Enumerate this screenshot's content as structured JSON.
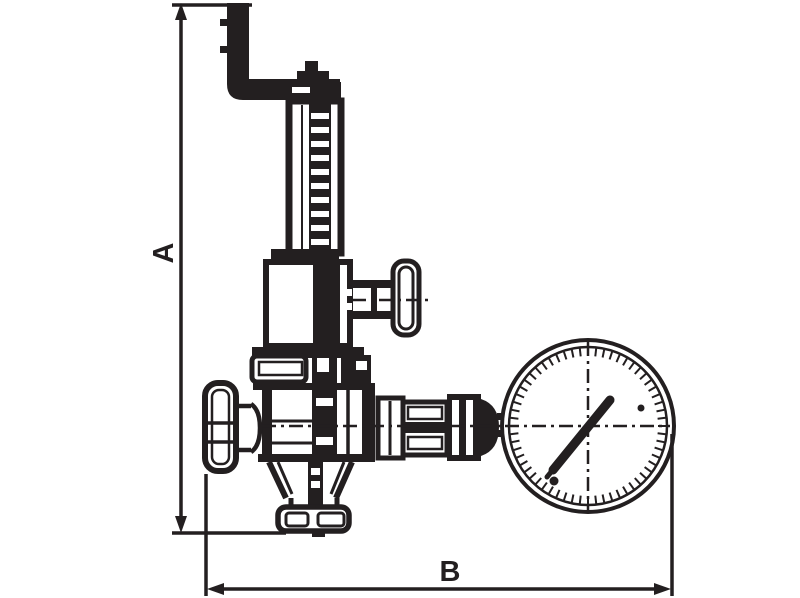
{
  "drawing": {
    "kind": "technical-line-drawing",
    "subject": "pressure reducing valve with relief T-handle and pressure gauge",
    "ink_color": "#231f20",
    "paper_color": "#ffffff",
    "labels": {
      "dimension_vertical": "A",
      "dimension_horizontal": "B"
    }
  }
}
